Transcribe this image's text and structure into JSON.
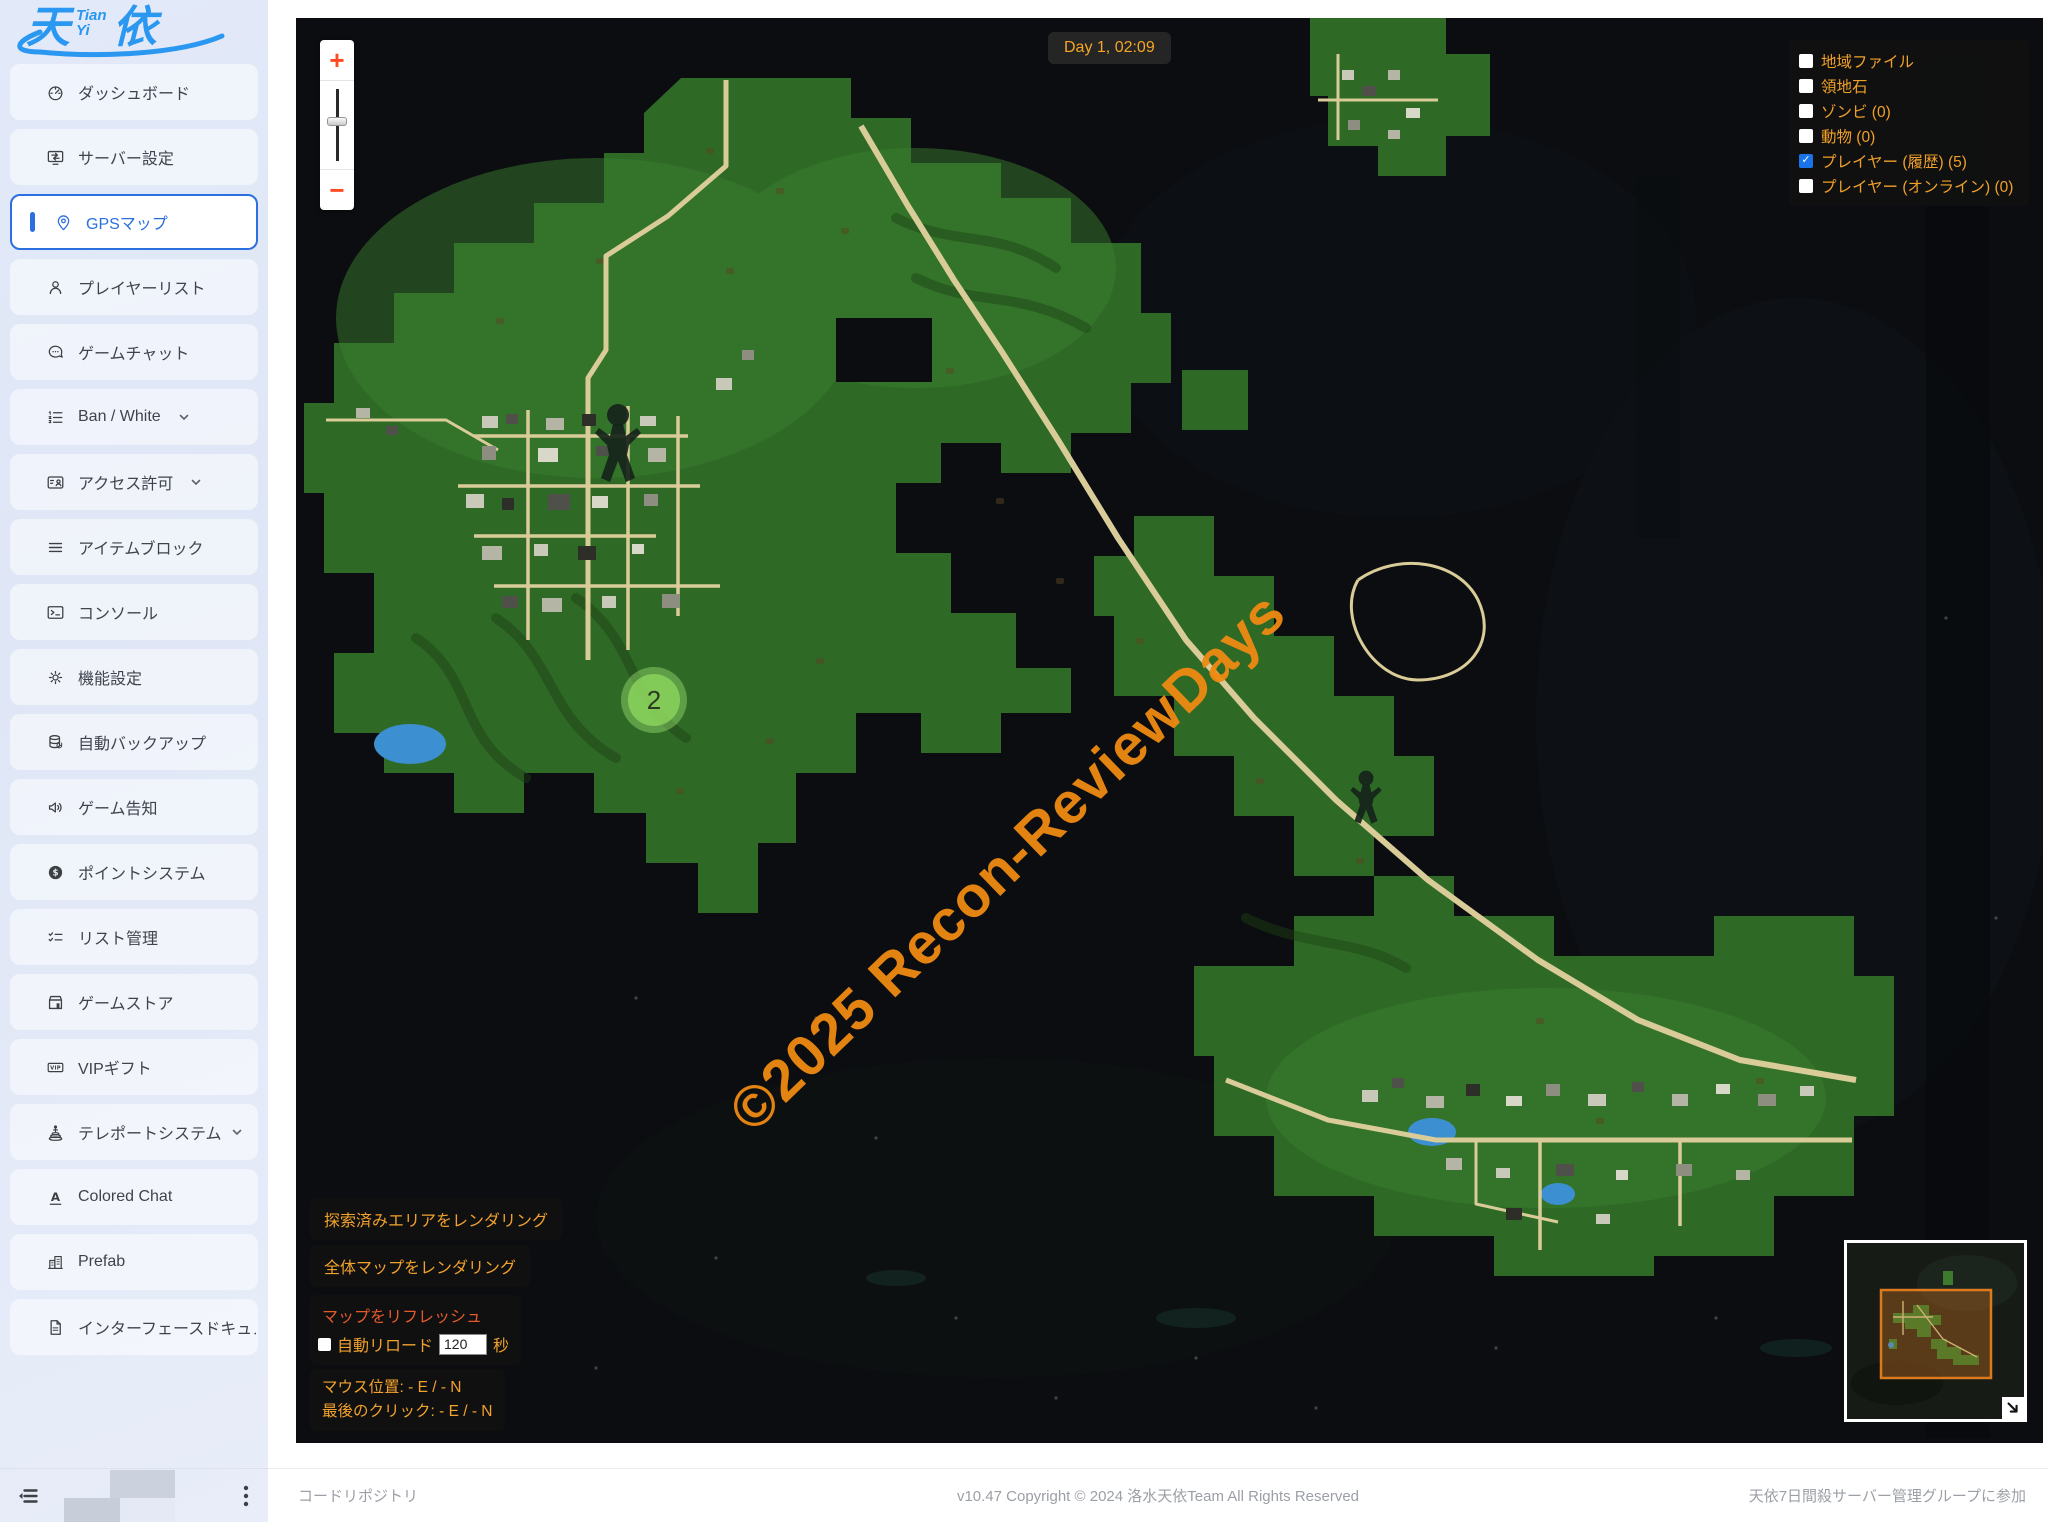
{
  "logo": {
    "left": "天",
    "top_small": "Tian",
    "bottom_small": "Yi",
    "right": "依"
  },
  "sidebar": {
    "items": [
      {
        "label": "ダッシュボード",
        "icon": "gauge",
        "active": false,
        "has_submenu": false
      },
      {
        "label": "サーバー設定",
        "icon": "server-settings",
        "active": false,
        "has_submenu": false
      },
      {
        "label": "GPSマップ",
        "icon": "map-pin",
        "active": true,
        "has_submenu": false
      },
      {
        "label": "プレイヤーリスト",
        "icon": "user",
        "active": false,
        "has_submenu": false
      },
      {
        "label": "ゲームチャット",
        "icon": "chat",
        "active": false,
        "has_submenu": false
      },
      {
        "label": "Ban / White",
        "icon": "ordered-list",
        "active": false,
        "has_submenu": true
      },
      {
        "label": "アクセス許可",
        "icon": "id-card",
        "active": false,
        "has_submenu": true
      },
      {
        "label": "アイテムブロック",
        "icon": "menu-lines",
        "active": false,
        "has_submenu": false
      },
      {
        "label": "コンソール",
        "icon": "terminal",
        "active": false,
        "has_submenu": false
      },
      {
        "label": "機能設定",
        "icon": "gear",
        "active": false,
        "has_submenu": false
      },
      {
        "label": "自動バックアップ",
        "icon": "database-backup",
        "active": false,
        "has_submenu": false
      },
      {
        "label": "ゲーム告知",
        "icon": "megaphone",
        "active": false,
        "has_submenu": false
      },
      {
        "label": "ポイントシステム",
        "icon": "dollar-coin",
        "active": false,
        "has_submenu": false
      },
      {
        "label": "リスト管理",
        "icon": "checklist",
        "active": false,
        "has_submenu": false
      },
      {
        "label": "ゲームストア",
        "icon": "storefront",
        "active": false,
        "has_submenu": false
      },
      {
        "label": "VIPギフト",
        "icon": "vip-badge",
        "active": false,
        "has_submenu": false
      },
      {
        "label": "テレポートシステム",
        "icon": "teleport",
        "active": false,
        "has_submenu": true
      },
      {
        "label": "Colored Chat",
        "icon": "letter-a",
        "active": false,
        "has_submenu": false
      },
      {
        "label": "Prefab",
        "icon": "building",
        "active": false,
        "has_submenu": false
      },
      {
        "label": "インターフェースドキュメント",
        "icon": "document",
        "active": false,
        "has_submenu": false
      }
    ]
  },
  "map": {
    "day_label": "Day 1, 02:09",
    "watermark": "©2025 Recon-ReviewDays",
    "cluster_count": "2",
    "zoom_in": "+",
    "zoom_out": "−",
    "layers": [
      {
        "label": "地域ファイル",
        "checked": false
      },
      {
        "label": "領地石",
        "checked": false
      },
      {
        "label": "ゾンビ (0)",
        "checked": false
      },
      {
        "label": "動物 (0)",
        "checked": false
      },
      {
        "label": "プレイヤー (履歴) (5)",
        "checked": true
      },
      {
        "label": "プレイヤー (オンライン) (0)",
        "checked": false
      }
    ],
    "buttons": {
      "render_explored": "探索済みエリアをレンダリング",
      "render_full": "全体マップをレンダリング"
    },
    "refresh": {
      "title": "マップをリフレッシュ",
      "auto_label": "自動リロード",
      "interval": "120",
      "unit": "秒",
      "checked": false
    },
    "position": {
      "mouse": "マウス位置: - E / - N",
      "last_click": "最後のクリック: - E / - N"
    }
  },
  "footer": {
    "left": "コードリポジトリ",
    "center": "v10.47 Copyright © 2024 洛水天依Team All Rights Reserved",
    "right": "天依7日間殺サーバー管理グループに参加"
  },
  "colors": {
    "accent_orange": "#f0a028",
    "refresh_red": "#e55a2b",
    "active_blue": "#2b6fe0",
    "logo_blue": "#2a97f0",
    "land_green": "#2e6a26",
    "road_tan": "#d9cc98",
    "water_blue": "#3c8fd0",
    "checkbox_blue": "#1a73e8",
    "zoom_plusminus": "#ff4b1f"
  }
}
